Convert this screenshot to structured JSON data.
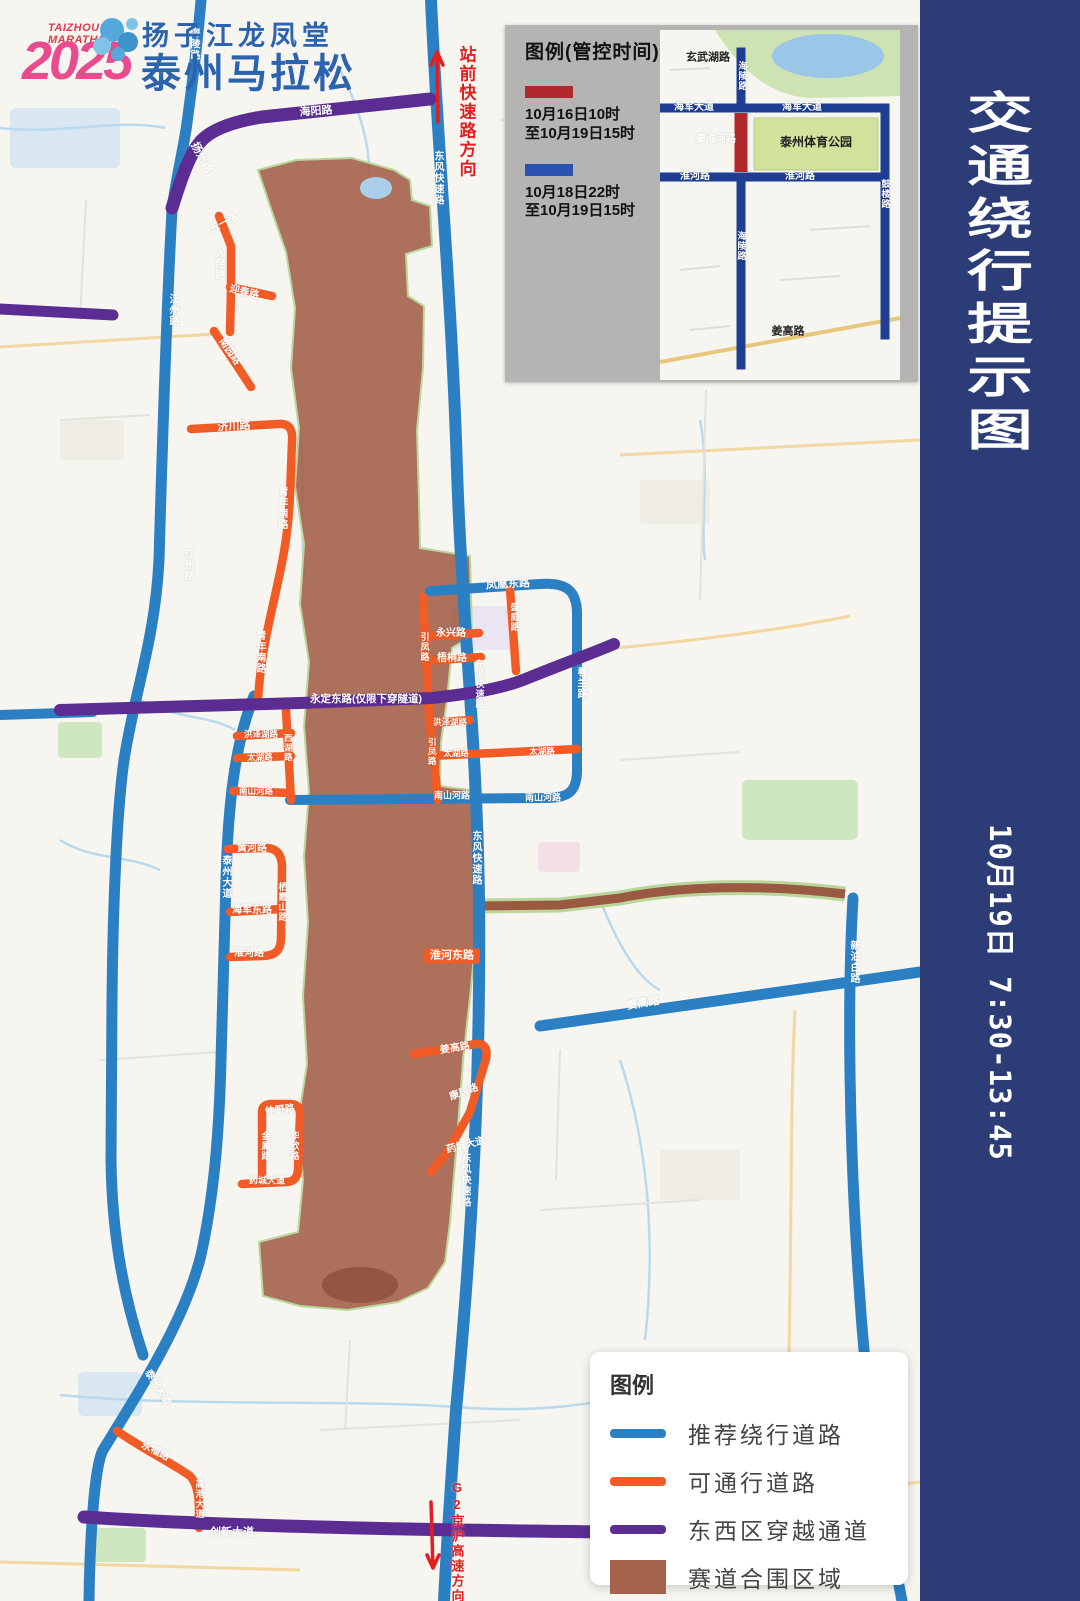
{
  "colors": {
    "sidebar_navy": "#2b3c77",
    "road_blue": "#2b80c4",
    "road_orange": "#f15b26",
    "road_purple": "#5b2c92",
    "race_area": "#a3624b",
    "inset_navy": "#1d3e93",
    "control_red": "#b0272c",
    "control_blue": "#2a52b0",
    "note_red": "#e31e1e"
  },
  "logo": {
    "brand_line1": "TAIZHOU",
    "brand_line2": "MARATHON",
    "year": "2025",
    "cn_line1": "扬子江龙凤堂",
    "cn_line2": "泰州马拉松"
  },
  "sidebar": {
    "title": "交通绕行提示图",
    "date_line": "10月19日  7:30-13:45"
  },
  "control_legend": {
    "title": "图例(管控时间)",
    "items": [
      {
        "color": "#b0272c",
        "line1": "10月16日10时",
        "line2": "至10月19日15时"
      },
      {
        "color": "#2a52b0",
        "line1": "10月18日22时",
        "line2": "至10月19日15时"
      }
    ]
  },
  "map_legend": {
    "title": "图例",
    "items": [
      {
        "type": "line",
        "color": "#2b80c4",
        "label": "推荐绕行道路"
      },
      {
        "type": "line",
        "color": "#f15b26",
        "label": "可通行道路"
      },
      {
        "type": "line",
        "color": "#5b2c92",
        "label": "东西区穿越通道"
      },
      {
        "type": "rect",
        "color": "#a3624b",
        "label": "赛道合围区域"
      }
    ]
  },
  "road_labels": [
    {
      "t": "海陵路",
      "x": 193,
      "y": 44,
      "v": 1,
      "s": 10
    },
    {
      "t": "扬州路",
      "x": 201,
      "y": 158,
      "r": 62,
      "s": 11
    },
    {
      "t": "海阳路",
      "x": 316,
      "y": 112,
      "r": -4,
      "s": 11
    },
    {
      "t": "站前快速路方向",
      "x": 466,
      "y": 112,
      "v": 1,
      "s": 17,
      "c": "red"
    },
    {
      "t": "东风快速路",
      "x": 437,
      "y": 178,
      "v": 1,
      "s": 10
    },
    {
      "t": "江州路",
      "x": 172,
      "y": 310,
      "v": 1,
      "s": 10
    },
    {
      "t": "五一路",
      "x": 224,
      "y": 224,
      "r": -28,
      "s": 10
    },
    {
      "t": "人民路",
      "x": 218,
      "y": 264,
      "v": 1,
      "s": 10
    },
    {
      "t": "迎春路",
      "x": 244,
      "y": 293,
      "r": 14,
      "s": 10
    },
    {
      "t": "南园路",
      "x": 229,
      "y": 352,
      "r": 55,
      "s": 10
    },
    {
      "t": "济川路",
      "x": 234,
      "y": 427,
      "r": -3,
      "s": 11
    },
    {
      "t": "青年南路",
      "x": 281,
      "y": 508,
      "v": 1,
      "s": 10
    },
    {
      "t": "江州路",
      "x": 187,
      "y": 565,
      "v": 1,
      "s": 10
    },
    {
      "t": "青年南路",
      "x": 259,
      "y": 652,
      "v": 1,
      "s": 10
    },
    {
      "t": "凤凰东路",
      "x": 508,
      "y": 585,
      "r": -3,
      "s": 11
    },
    {
      "t": "盛庭路",
      "x": 514,
      "y": 617,
      "v": 1,
      "s": 9
    },
    {
      "t": "永兴路",
      "x": 451,
      "y": 634,
      "s": 10
    },
    {
      "t": "梧桐路",
      "x": 452,
      "y": 659,
      "s": 10
    },
    {
      "t": "引凤路",
      "x": 424,
      "y": 647,
      "v": 1,
      "s": 9
    },
    {
      "t": "春兰路",
      "x": 580,
      "y": 683,
      "v": 1,
      "s": 10
    },
    {
      "t": "东风快速路",
      "x": 479,
      "y": 684,
      "v": 1,
      "s": 9
    },
    {
      "t": "永定东路(仅限下穿隧道)",
      "x": 366,
      "y": 699,
      "s": 10.5
    },
    {
      "t": "洪泽湖路",
      "x": 261,
      "y": 734,
      "s": 8.5
    },
    {
      "t": "西湖路",
      "x": 288,
      "y": 748,
      "v": 1,
      "s": 8.5
    },
    {
      "t": "太湖路",
      "x": 260,
      "y": 757,
      "s": 8.5
    },
    {
      "t": "洪泽湖路",
      "x": 450,
      "y": 722,
      "s": 8.5
    },
    {
      "t": "引凤路",
      "x": 432,
      "y": 752,
      "v": 1,
      "s": 8.5
    },
    {
      "t": "太湖路",
      "x": 456,
      "y": 753,
      "s": 8.5
    },
    {
      "t": "太湖路",
      "x": 542,
      "y": 751,
      "s": 8.5
    },
    {
      "t": "南山河路",
      "x": 256,
      "y": 791,
      "s": 8.5
    },
    {
      "t": "南山河路",
      "x": 452,
      "y": 796,
      "s": 9
    },
    {
      "t": "南山河路",
      "x": 543,
      "y": 798,
      "s": 9
    },
    {
      "t": "泰州大道",
      "x": 225,
      "y": 877,
      "v": 1,
      "s": 10
    },
    {
      "t": "黄河路",
      "x": 252,
      "y": 849,
      "s": 10
    },
    {
      "t": "栖霞山路",
      "x": 282,
      "y": 902,
      "v": 1,
      "s": 9
    },
    {
      "t": "海军东路",
      "x": 252,
      "y": 911,
      "s": 10
    },
    {
      "t": "淮河路",
      "x": 249,
      "y": 954,
      "s": 10
    },
    {
      "t": "东风快速路",
      "x": 475,
      "y": 858,
      "v": 1,
      "s": 10
    },
    {
      "t": "淮河东路",
      "x": 452,
      "y": 956,
      "s": 11,
      "c": "obox"
    },
    {
      "t": "姜高路",
      "x": 643,
      "y": 1004,
      "r": -9,
      "s": 11
    },
    {
      "t": "新泊白路",
      "x": 853,
      "y": 962,
      "v": 1,
      "s": 10
    },
    {
      "t": "姜高路",
      "x": 455,
      "y": 1049,
      "r": -8,
      "s": 10
    },
    {
      "t": "康居路",
      "x": 464,
      "y": 1093,
      "r": -20,
      "s": 10
    },
    {
      "t": "药城大道",
      "x": 466,
      "y": 1146,
      "r": -14,
      "s": 10
    },
    {
      "t": "仲野路",
      "x": 280,
      "y": 1111,
      "r": -6,
      "s": 10
    },
    {
      "t": "金属路",
      "x": 265,
      "y": 1146,
      "v": 1,
      "s": 9
    },
    {
      "t": "华欣路",
      "x": 294,
      "y": 1146,
      "v": 1,
      "s": 9
    },
    {
      "t": "药城大道",
      "x": 267,
      "y": 1181,
      "s": 9
    },
    {
      "t": "东风快速路",
      "x": 464,
      "y": 1180,
      "v": 1,
      "s": 10
    },
    {
      "t": "泰州大道",
      "x": 157,
      "y": 1388,
      "r": 58,
      "s": 10
    },
    {
      "t": "永福路",
      "x": 155,
      "y": 1452,
      "r": 27,
      "s": 10
    },
    {
      "t": "高港大道",
      "x": 199,
      "y": 1499,
      "v": 1,
      "s": 9
    },
    {
      "t": "创新大道",
      "x": 232,
      "y": 1533,
      "s": 11
    },
    {
      "t": "G2京沪高速方向",
      "x": 457,
      "y": 1542,
      "v": 1,
      "s": 13,
      "c": "red"
    }
  ],
  "inset": {
    "labels": [
      {
        "t": "玄武湖路",
        "x": 48,
        "y": 28,
        "c": "dk",
        "s": 11
      },
      {
        "t": "海陵路",
        "x": 82,
        "y": 46,
        "v": 1,
        "s": 9
      },
      {
        "t": "海军大道",
        "x": 34,
        "y": 78,
        "s": 10
      },
      {
        "t": "海军大道",
        "x": 142,
        "y": 78,
        "s": 10
      },
      {
        "t": "秦淮河路",
        "x": 56,
        "y": 110,
        "s": 10
      },
      {
        "t": "泰州体育公园",
        "x": 156,
        "y": 112,
        "c": "dk",
        "s": 12
      },
      {
        "t": "淮河路",
        "x": 35,
        "y": 147,
        "s": 10
      },
      {
        "t": "淮河路",
        "x": 140,
        "y": 147,
        "s": 10
      },
      {
        "t": "海陵路",
        "x": 81,
        "y": 216,
        "v": 1,
        "s": 9
      },
      {
        "t": "鼓楼路",
        "x": 225,
        "y": 164,
        "v": 1,
        "s": 9
      },
      {
        "t": "姜高路",
        "x": 128,
        "y": 302,
        "c": "dk",
        "s": 11
      }
    ]
  }
}
